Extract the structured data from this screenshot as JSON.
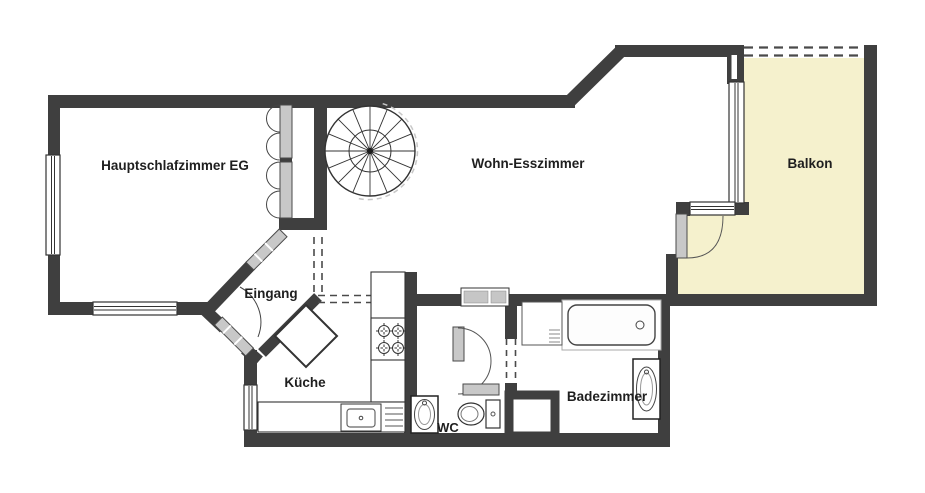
{
  "plan": {
    "type": "floor-plan",
    "rooms": {
      "bedroom": {
        "label": "Hauptschlafzimmer EG"
      },
      "living": {
        "label": "Wohn-Esszimmer"
      },
      "balcony": {
        "label": "Balkon"
      },
      "entrance": {
        "label": "Eingang"
      },
      "kitchen": {
        "label": "Küche"
      },
      "wc": {
        "label": "WC"
      },
      "bathroom": {
        "label": "Badezimmer"
      }
    },
    "fixtures": [
      "spiral-staircase",
      "stove-4-burners",
      "kitchen-sink",
      "dining-table",
      "bathtub",
      "washer",
      "bathroom-sink",
      "shower",
      "wc-sink",
      "toilet",
      "hall-closet"
    ],
    "colors": {
      "wall": "#3f3f3f",
      "balcony_fill": "#f5f1cd",
      "door_leaf": "#c8c8c8",
      "background": "#ffffff"
    }
  }
}
